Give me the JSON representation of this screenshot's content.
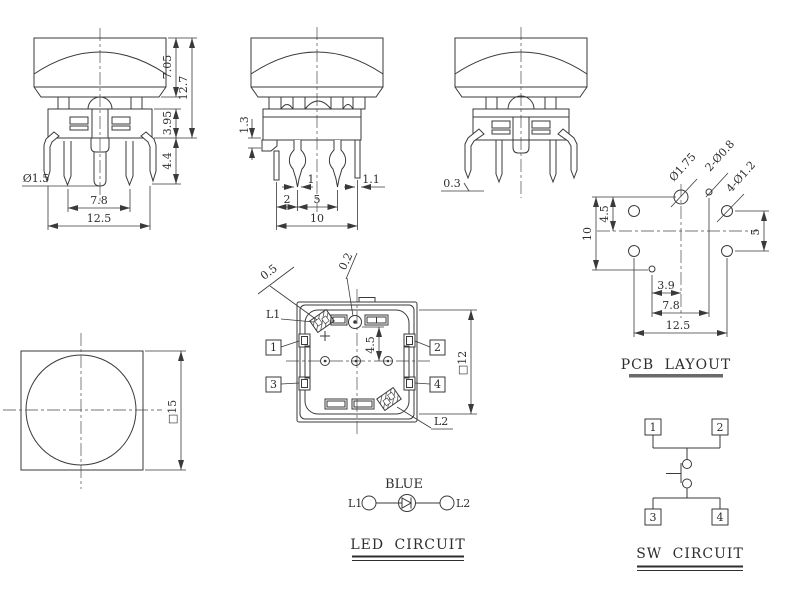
{
  "front_view": {
    "dims": {
      "cap_height": "7.05",
      "total_height": "12.7",
      "body_height": "3.95",
      "pin_length": "4.4",
      "pin_diameter": "Ø1.5",
      "inner_pin_pitch": "7.8",
      "outer_pin_pitch": "12.5"
    }
  },
  "side_view": {
    "dims": {
      "step_height": "1.3",
      "pin_tip_width": "1",
      "post_width": "1.1",
      "pitch_left": "2",
      "pitch_center": "5",
      "pitch_overall": "10"
    }
  },
  "back_view": {
    "dims": {
      "standoff": "0.3"
    }
  },
  "bottom_view": {
    "dims": {
      "pad_a": "0.5",
      "pad_b": "0.2",
      "led_row_offset": "4.5",
      "body_square": "□12"
    },
    "labels": {
      "led1": "L1",
      "led2": "L2",
      "pin1": "1",
      "pin2": "2",
      "pin3": "3",
      "pin4": "4"
    }
  },
  "top_view": {
    "dims": {
      "cap_square": "□15"
    }
  },
  "pcb_layout": {
    "title": "PCB LAYOUT",
    "holes": {
      "center_hole": "Ø1.75",
      "led_holes": "2-Ø0.8",
      "pin_holes": "4-Ø1.2"
    },
    "dims": {
      "row_offset": "4.5",
      "row_span": "10",
      "right_span": "5",
      "led_offset_x": "3.9",
      "led_span": "7.8",
      "pin_span": "12.5"
    }
  },
  "led_circuit": {
    "title": "LED CIRCUIT",
    "color": "BLUE",
    "left_terminal": "L1",
    "right_terminal": "L2"
  },
  "sw_circuit": {
    "title": "SW CIRCUIT",
    "pins": [
      "1",
      "2",
      "3",
      "4"
    ]
  }
}
